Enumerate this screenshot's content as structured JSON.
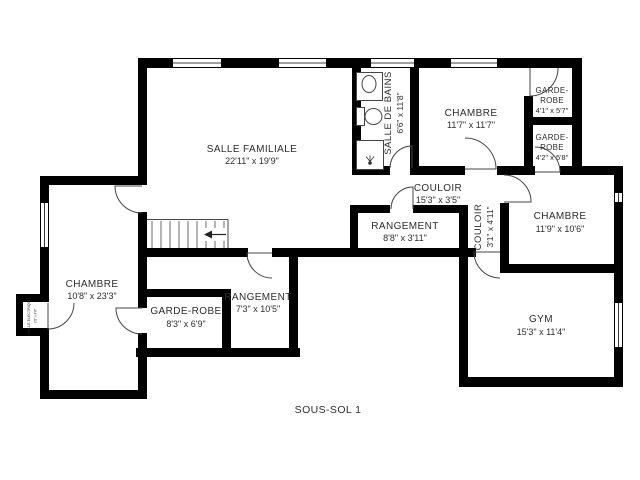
{
  "title": "SOUS-SOL 1",
  "colors": {
    "wall": "#000000",
    "line": "#454545",
    "text": "#2d2d2d"
  },
  "rooms": {
    "salle_familiale": {
      "name": "SALLE FAMILIALE",
      "dims": "22'11\" x 19'9\""
    },
    "salle_de_bains": {
      "name": "SALLE DE BAINS",
      "dims": "6'6\" x 11'8\""
    },
    "chambre_nord": {
      "name": "CHAMBRE",
      "dims": "11'7\" x 11'7\""
    },
    "garde_robe_1": {
      "line1": "GARDE-",
      "line2": "ROBE",
      "dims": "4'1\" x 5'7\""
    },
    "garde_robe_2": {
      "line1": "GARDE-",
      "line2": "ROBE",
      "dims": "4'2\" x 5'8\""
    },
    "couloir": {
      "name": "COULOIR",
      "dims": "15'3\" x 3'5\""
    },
    "couloir_vertical": {
      "name": "COULOIR",
      "dims": "3'1\" x 4'11\""
    },
    "chambre_est": {
      "name": "CHAMBRE",
      "dims": "11'9\" x 10'6\""
    },
    "rangement_haut": {
      "name": "RANGEMENT",
      "dims": "8'8\" x 3'11\""
    },
    "chambre_ouest": {
      "name": "CHAMBRE",
      "dims": "10'8\" x 23'3\""
    },
    "garde_robe_3": {
      "name": "GARDE-ROBE",
      "dims": "8'3\" x 6'9\""
    },
    "rangement_bas": {
      "name": "RANGEMENT",
      "dims": "7'3\" x 10'5\""
    },
    "gym": {
      "name": "GYM",
      "dims": "15'3\" x 11'4\""
    },
    "salle_electrique": {
      "name": "SALLE ÉLECTRIQUE",
      "dims": "1'8\" x 4'8\""
    }
  }
}
